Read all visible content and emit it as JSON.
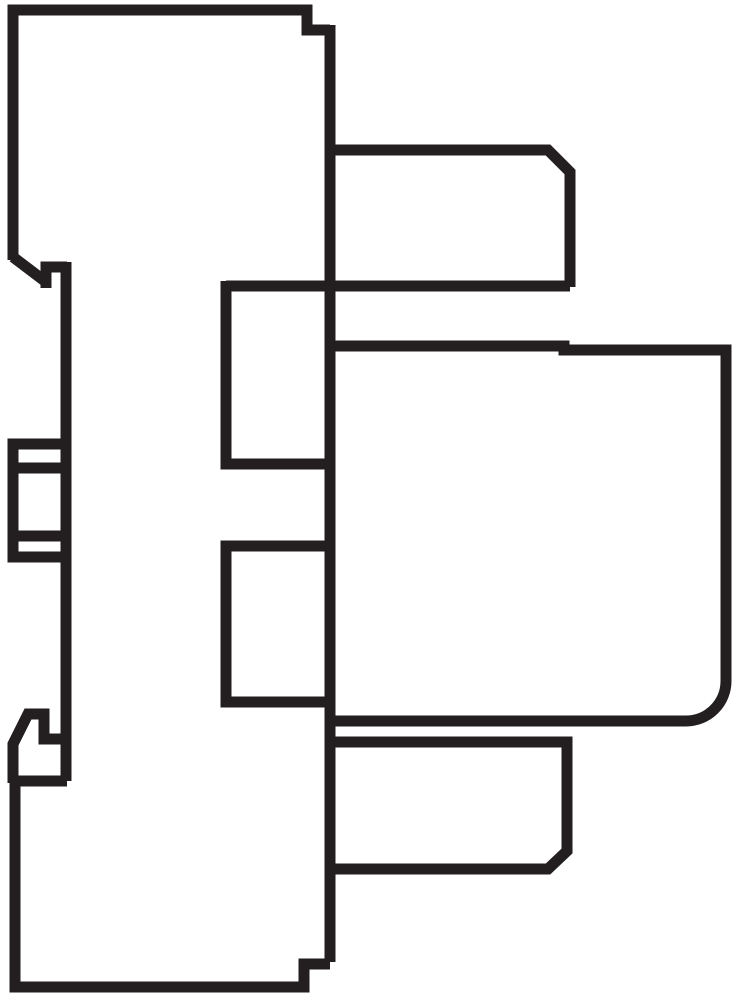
{
  "document": {
    "title": "relay-and-socket-side-profile-line-drawing",
    "description": "Black outline technical side view of a plug-in relay module mounted on a DIN-rail socket"
  },
  "canvas": {
    "width": 737,
    "height": 1000,
    "background_color": "#ffffff"
  },
  "line_style": {
    "stroke_color": "#231f20",
    "stroke_width": 11
  },
  "shapes": [
    {
      "name": "socket-top-outline",
      "d": "M 13 260 L 13 10 L 307 10 L 307 30 L 330 30"
    },
    {
      "name": "left-edge-diagonal",
      "d": "M 13 257 L 46 282"
    },
    {
      "name": "left-edge-notch",
      "d": "M 46 288 L 46 267 L 67 267"
    },
    {
      "name": "inner-left-edge",
      "d": "M 66 262 L 66 781"
    },
    {
      "name": "center-vertical-edge",
      "d": "M 330 25 L 330 962"
    },
    {
      "name": "upper-arm-outline",
      "d": "M 330 150 L 548 150 L 570 172 L 570 287"
    },
    {
      "name": "upper-ledge-line",
      "d": "M 226 286 L 570 286"
    },
    {
      "name": "upper-window-outline",
      "d": "M 226 281 L 226 464 L 330 464"
    },
    {
      "name": "lower-window-outline",
      "d": "M 330 546 L 226 546 L 226 702 L 330 702"
    },
    {
      "name": "relay-body-outline",
      "d": "M 330 346 L 564 346 L 564 350 L 726 350 L 726 681 A 40 40 0 0 1 686 721 L 330 721"
    },
    {
      "name": "lower-arm-outline",
      "d": "M 330 742 L 567 742 L 567 851 L 548 869 L 330 869"
    },
    {
      "name": "socket-bottom-outline",
      "d": "M 330 964 L 304 964 L 304 987 L 15 987 L 15 781 L 67 781"
    },
    {
      "name": "din-rail-clip-outline",
      "d": "M 67 739 L 44 739 L 44 714 L 28 714 L 13 744 L 13 783"
    },
    {
      "name": "terminal-clamp-outline",
      "d": "M 13 444 L 66 444 L 66 557 L 13 557 Z"
    },
    {
      "name": "terminal-clamp-upper-line",
      "d": "M 13 468 L 66 468"
    },
    {
      "name": "terminal-clamp-lower-line",
      "d": "M 13 536 L 66 536"
    }
  ]
}
